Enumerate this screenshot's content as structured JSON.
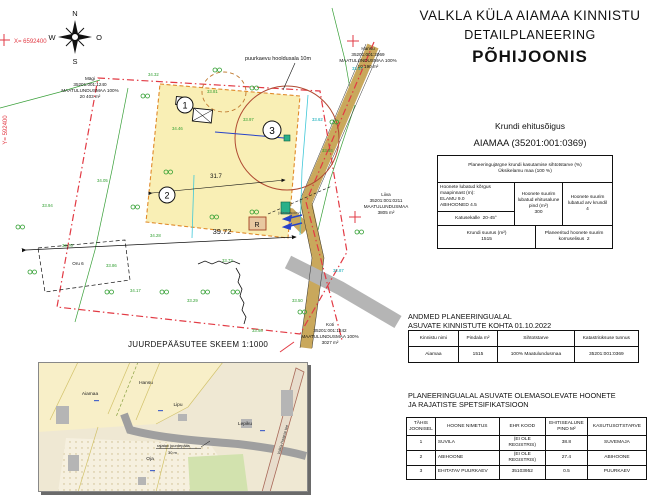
{
  "title": {
    "line1": "VALKLA KÜLA AIAMAA KINNISTU",
    "line2": "DETAILPLANEERING",
    "line3": "PÕHIJOONIS"
  },
  "compass": {
    "n": "N",
    "s": "S",
    "w": "W",
    "e": "O"
  },
  "coords": {
    "x_label": "X= 6592400",
    "y_label": "Y= 592400"
  },
  "building_rights": {
    "heading": "Krundi ehitusõigus",
    "subheading": "AIAMAA (35201:001:0369)",
    "purpose_line1": "Planeeringujärgne krundi kasutamise sihtotstarve (%)",
    "purpose_line2": "Üksikelamu maa (100 %)",
    "height_label": "Hoonete lubatud kõrgus maapinnast (m):",
    "height_elamu": "ELAMU 9.0",
    "height_abihooned": "ABIHOONED 4.5",
    "roof_label": "Katusekalle",
    "roof_value": "20-45°",
    "building_area_label": "Hoonete suurim lubatud ehitusalune pind (m²)",
    "building_area_value": "300",
    "max_buildings_label": "Hoonete suurim lubatud arv krundil",
    "max_buildings_value": "4",
    "plot_size_label": "Krundi suurus (m²)",
    "plot_size_value": "1515",
    "storeys_label": "Planeeritud hoonete suurim korruselisus",
    "storeys_value": "2"
  },
  "cadastral_table": {
    "heading_line1": "ANDMED PLANEERINGUALAL",
    "heading_line2": "ASUVATE KINNISTUTE KOHTA 01.10.2022",
    "headers": [
      "Kinnistu nimi",
      "Pindala m²",
      "Sihtotstarve",
      "Katastriüksuse tunnus"
    ],
    "rows": [
      [
        "Aiamaa",
        "1515",
        "100% Maatulundusmaa",
        "35201:001:0369"
      ]
    ]
  },
  "spec_table": {
    "heading_line1": "PLANEERINGUALAL ASUVATE  OLEMASOLEVATE HOONETE",
    "heading_line2": "JA RAJATISTE SPETSIFIKATSIOON",
    "headers": [
      "TÄHIS JOONISEL",
      "HOONE NIMETUS",
      "EHR KOOD",
      "EHITISEALUNE PIND M²",
      "KASUTUSOTSTARVE"
    ],
    "rows": [
      [
        "1",
        "SUVILA",
        "(EI OLE REGISTRIS)",
        "38.8",
        "SUVEMAJA"
      ],
      [
        "2",
        "ABIHOONE",
        "(EI OLE REGISTRIS)",
        "27.4",
        "ABIHOONE"
      ],
      [
        "3",
        "EHITATAV PUURKAEV",
        "35103952",
        "0.5",
        "PUURKAEV"
      ]
    ]
  },
  "map": {
    "well_zone_label": "puurkaevu hooldusala 10m",
    "dim_main": "39.72",
    "dim_inner": "31.7",
    "pos1": "1",
    "pos2": "2",
    "pos3": "3",
    "r_box": "R",
    "r_note": "(olemasolev)",
    "parcels": {
      "magi": [
        "Mägi",
        "35201:001:1240",
        "MAATULUNDUSMAA 100%",
        "20 403 m²"
      ],
      "hansu": [
        "Hansu",
        "35201:001:2069",
        "MAATULUNDUSMAA 100%",
        "10 190 m²"
      ],
      "liiva": [
        "Liiva",
        "35201:001:0211",
        "MAATULUNDUSMAA",
        "3805 m²"
      ],
      "koti": [
        "Koti",
        "35201:001:1242",
        "MAATULUNDUSMAA 100%",
        "3027 m²"
      ],
      "oru": "Oru 6"
    },
    "elevations": [
      "34.32",
      "33.81",
      "33.97",
      "34.46",
      "33.62",
      "33.47",
      "33.84",
      "34.28",
      "34.17",
      "33.29",
      "33.50",
      "33.98",
      "32.87",
      "33.86",
      "33.70",
      "33.94",
      "34.05",
      "33.72"
    ]
  },
  "inset": {
    "title": "JUURDEPÄÄSUTEE SKEEM 1:1000",
    "labels": {
      "aiamaa": "Aiamaa",
      "hansu": "Hansu",
      "lipu": "Lipu",
      "lepiku": "Lepiku",
      "oja": "Oja",
      "road": "Valkla-Haapse tee",
      "annotation_line1": "rajatav juurdepääs",
      "annotation_line2": "30 m"
    }
  },
  "colors": {
    "boundary_red": "#e23a44",
    "buildable_yellow": "#f9efb5",
    "road_tan": "#c9a85c",
    "green": "#2f9e2f",
    "teal": "#00a6b4",
    "blue": "#2743c9"
  }
}
